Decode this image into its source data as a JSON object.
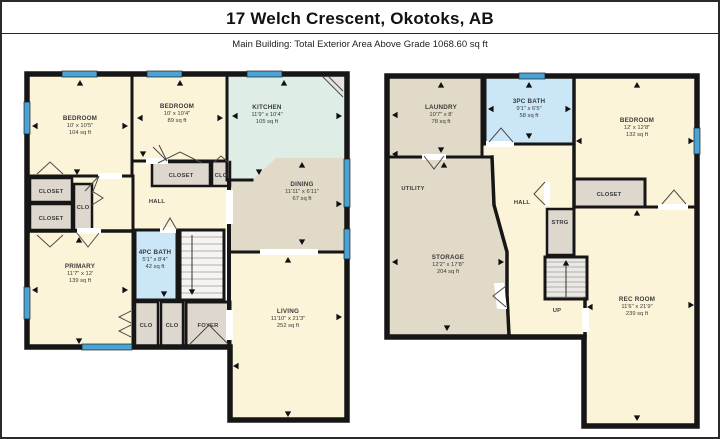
{
  "header": {
    "title": "17 Welch Crescent, Okotoks, AB",
    "subtitle": "Main Building: Total Exterior Area Above Grade 1068.60 sq ft"
  },
  "colors": {
    "wall": "#161616",
    "window_blue": "#4aa3d6",
    "room_cream": "#fbf4d8",
    "room_tan": "#e2dac8",
    "room_teal": "#deeee6",
    "room_bath_blue": "#cbe6f7",
    "room_gray": "#ddd7ce",
    "stair_light": "#f6f4f0"
  },
  "floors": {
    "main": {
      "rooms": {
        "bedroom1": {
          "name": "BEDROOM",
          "dims": "10' x 10'5\"",
          "area": "104 sq ft"
        },
        "bedroom2": {
          "name": "BEDROOM",
          "dims": "10' x 10'4\"",
          "area": "89 sq ft"
        },
        "kitchen": {
          "name": "KITCHEN",
          "dims": "11'9\" x 10'4\"",
          "area": "105 sq ft"
        },
        "dining": {
          "name": "DINING",
          "dims": "11'11\" x 6'11\"",
          "area": "67 sq ft"
        },
        "primary": {
          "name": "PRIMARY",
          "dims": "11'7\" x 12'",
          "area": "139 sq ft"
        },
        "bath4pc": {
          "name": "4PC BATH",
          "dims": "5'1\" x 8'4\"",
          "area": "42 sq ft"
        },
        "living": {
          "name": "LIVING",
          "dims": "11'10\" x 21'3\"",
          "area": "252 sq ft"
        },
        "hall": {
          "name": "HALL"
        },
        "foyer": {
          "name": "FOYER"
        },
        "closet_a": {
          "name": "CLOSET"
        },
        "closet_b": {
          "name": "CLOSET"
        },
        "closet_c": {
          "name": "CLOSET"
        },
        "clo_a": {
          "name": "CLO"
        },
        "clo_b": {
          "name": "CLO"
        },
        "clo_c": {
          "name": "CLO"
        },
        "clo_d": {
          "name": "CLO"
        }
      }
    },
    "basement": {
      "rooms": {
        "laundry": {
          "name": "LAUNDRY",
          "dims": "10'7\" x 8'",
          "area": "78 sq ft"
        },
        "bath3pc": {
          "name": "3PC BATH",
          "dims": "9'1\" x 6'5\"",
          "area": "58 sq ft"
        },
        "bedroom": {
          "name": "BEDROOM",
          "dims": "12' x 12'8\"",
          "area": "132 sq ft"
        },
        "utility": {
          "name": "UTILITY"
        },
        "storage": {
          "name": "STORAGE",
          "dims": "12'2\" x 17'8\"",
          "area": "204 sq ft"
        },
        "hall": {
          "name": "HALL"
        },
        "strg": {
          "name": "STRG"
        },
        "closet": {
          "name": "CLOSET"
        },
        "stairs_up": {
          "name": "UP"
        },
        "rec": {
          "name": "REC ROOM",
          "dims": "11'6\" x 21'9\"",
          "area": "239 sq ft"
        }
      }
    }
  }
}
